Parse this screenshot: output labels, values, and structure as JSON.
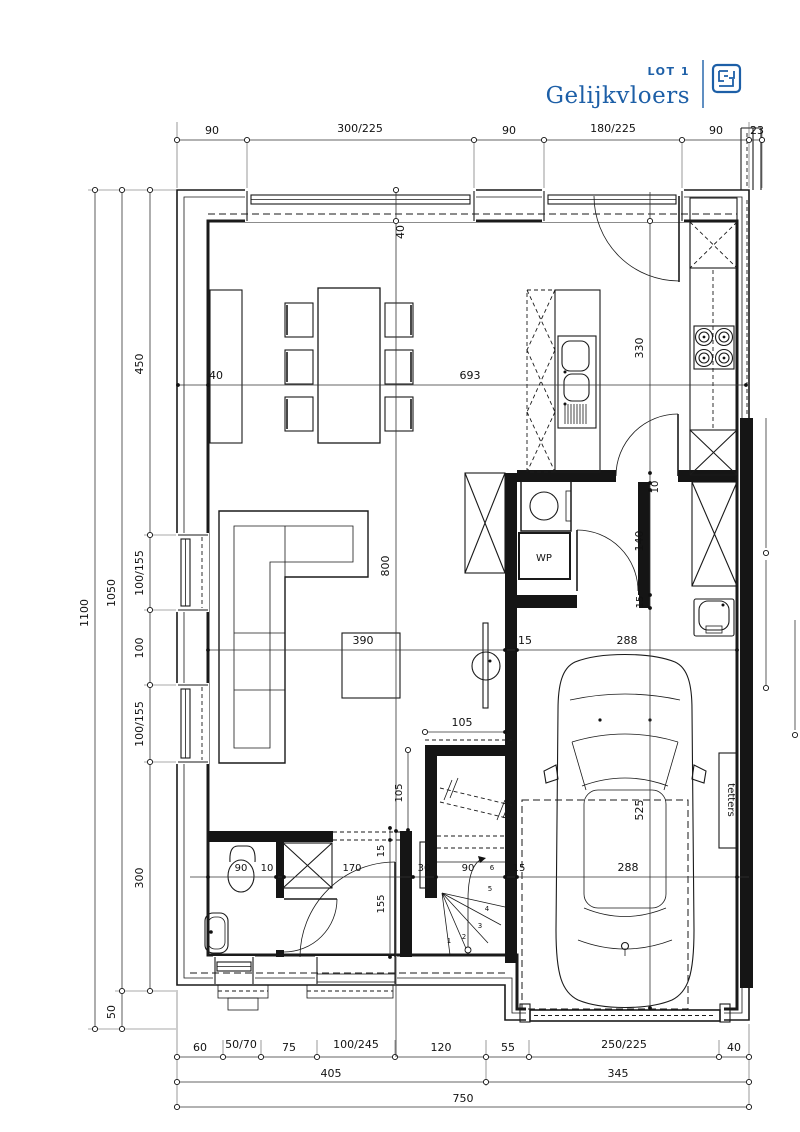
{
  "title": {
    "lot": "LOT 1",
    "floor": "Gelijkvloers"
  },
  "colors": {
    "accent": "#1d5fa7",
    "line": "#1a1a1a"
  },
  "dims": {
    "top": [
      "90",
      "300/225",
      "90",
      "180/225",
      "90",
      "23"
    ],
    "left_outer": "1100",
    "left_mid": [
      "1050",
      "50"
    ],
    "left_inner": [
      "450",
      "100/155",
      "100",
      "100/155",
      "300"
    ],
    "bottom1": [
      "60",
      "50/70",
      "75",
      "100/245",
      "120",
      "55",
      "250/225",
      "40"
    ],
    "bottom2": [
      "405",
      "345"
    ],
    "bottom3": "750",
    "w40_top": "40",
    "w40_left": "40",
    "i693": "693",
    "i330": "330",
    "i800": "800",
    "i390": "390",
    "i15a": "15",
    "i288a": "288",
    "i10": "10",
    "i140": "140",
    "i15b": "15",
    "i525": "525",
    "i288b": "288",
    "i105h": "105",
    "i105v": "105",
    "i15c": "15",
    "i155": "155",
    "c877": [
      "90",
      "10",
      "170",
      "30",
      "90",
      "15"
    ]
  },
  "labels": {
    "wp": "WP",
    "garage_side": "tetters"
  },
  "stairs": {
    "treads": [
      "1",
      "2",
      "3",
      "4",
      "5",
      "6",
      "7"
    ]
  }
}
